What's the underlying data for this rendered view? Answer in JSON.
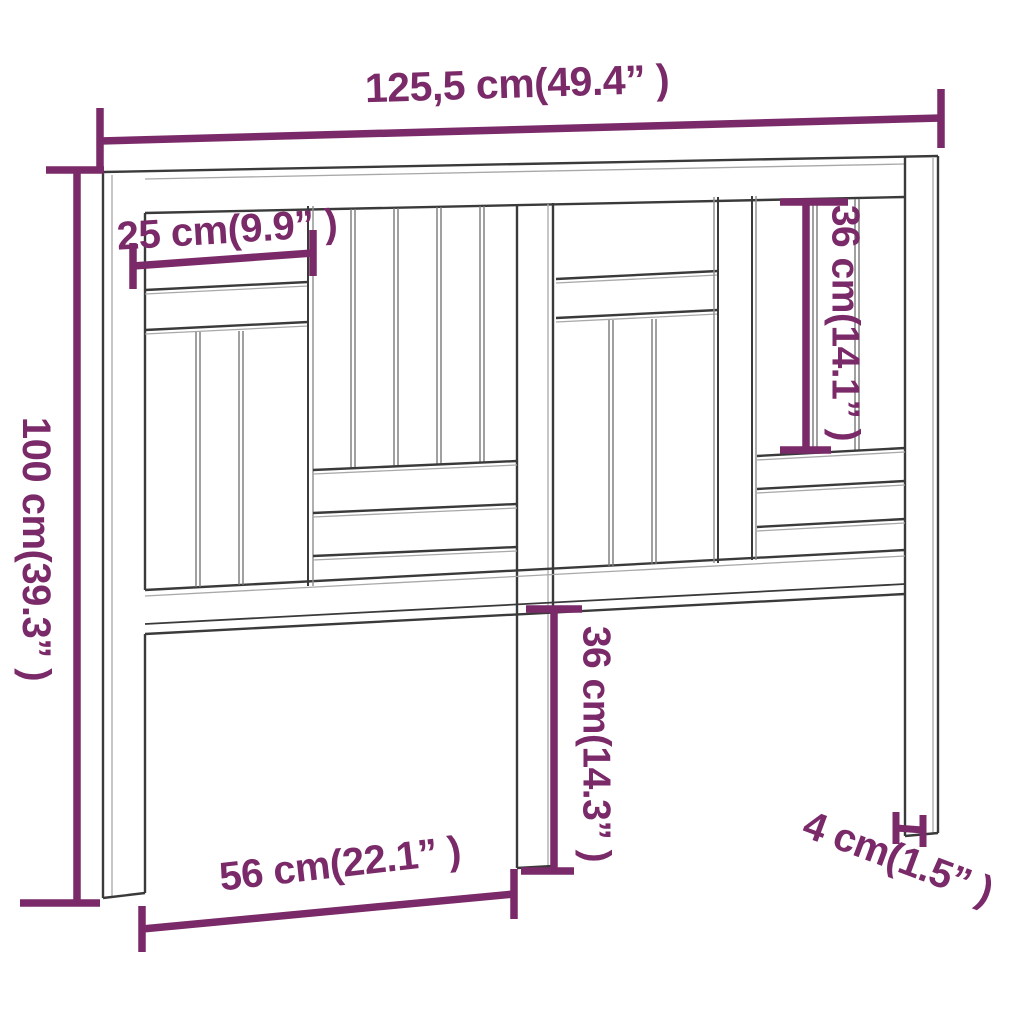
{
  "diagram": {
    "subject": "headboard",
    "colors": {
      "accent": "#7a2a68",
      "line_dark": "#3a3a3a",
      "line_light": "#a0a0a0",
      "background": "#ffffff"
    },
    "dimensions": {
      "overall_width": "125,5 cm(49.4” )",
      "slat_width": "25 cm(9.9” )",
      "overall_height": "100 cm(39.3” )",
      "upper_panel_height": "36 cm(14.1” )",
      "leg_height": "36 cm(14.3” )",
      "leg_spacing": "56 cm(22.1” )",
      "leg_thickness": "4 cm(1.5” )"
    }
  }
}
